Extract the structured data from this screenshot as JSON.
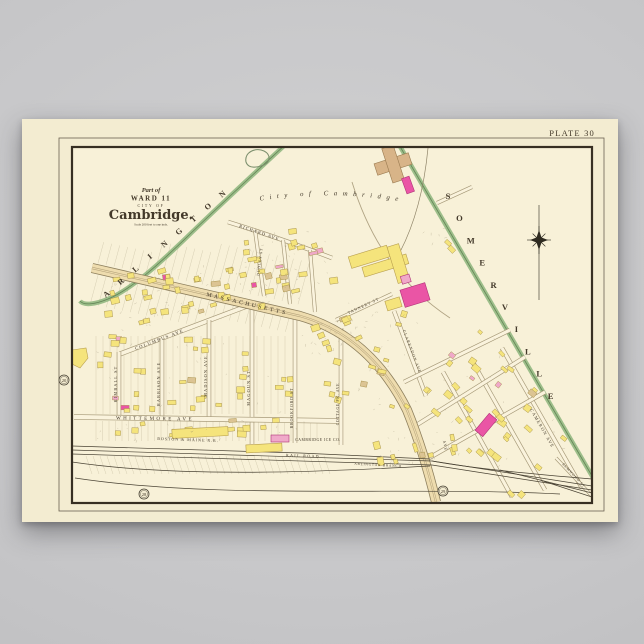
{
  "product": {
    "background_color": "#c7c7c9"
  },
  "poster": {
    "paper_color": "#f3ecd1",
    "map_bg_color": "#f8f1d8",
    "plate_label": "PLATE 30",
    "cartouche": {
      "ornament": "~",
      "part_of": "Part of",
      "ward": "WARD 11",
      "city_of": "CITY OF",
      "city": "Cambridge.",
      "scale_note": "Scale 200 feet to one inch."
    },
    "boundaries": {
      "left_city": "ARLINGTON",
      "right_city": "SOMERVILLE",
      "inner_city": "City of Cambridge"
    },
    "plate_refs": [
      {
        "label": "20"
      },
      {
        "label": "28"
      },
      {
        "label": "29"
      }
    ],
    "streets": {
      "massachusetts": "MASSACHUSETTS",
      "ave_abbr": "AVE",
      "columbus": "COLUMBUS AVE",
      "kimball": "KIMBALL ST",
      "harrison": "HARRISON AVE",
      "madison": "MADISON AVE",
      "magoun": "MAGOUN ST",
      "whittemore": "WHITTEMORE AVE",
      "brookford": "BROOKFORD ST",
      "cottage_park": "COTTAGE PK. AVE",
      "tannery": "TANNERY ST",
      "richard": "RICHARD AVE",
      "dudley": "DUDLEY ST",
      "clarendon": "CLARENDON AVE",
      "cameron": "CAMERON AVE",
      "elmwood": "ELMWOOD ST"
    },
    "railroad": {
      "boston_maine": "BOSTON & MAINE R.R.",
      "rail_road": "RAIL ROAD",
      "branch": "ARLINGTON BRANCH"
    },
    "landmarks": {
      "ice_company": "CAMBRIDGE ICE CO."
    },
    "legend_colors": {
      "wood_building": "#f5e47c",
      "brick_building": "#ea55a5",
      "boundary_green": "#86b277",
      "avenue_fill": "#eedcae"
    }
  }
}
